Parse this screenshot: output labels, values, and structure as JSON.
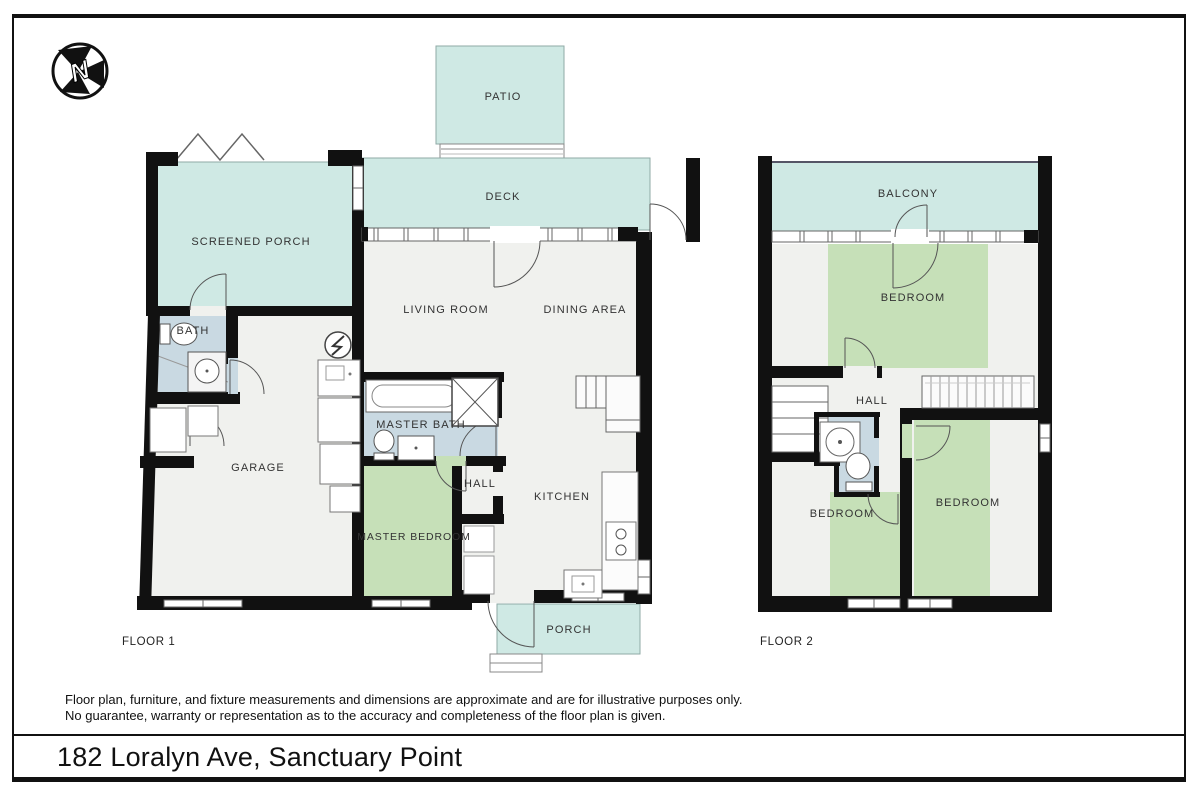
{
  "page": {
    "address": "182 Loralyn Ave, Sanctuary Point",
    "disclaimer_line1": "Floor plan, furniture, and fixture measurements and dimensions are approximate and are for illustrative purposes only.",
    "disclaimer_line2": "No guarantee, warranty or representation as to the accuracy and completeness of the floor plan is given.",
    "north_label": "N"
  },
  "floor1": {
    "label": "FLOOR 1",
    "rooms": {
      "patio": "PATIO",
      "deck": "DECK",
      "screened_porch": "SCREENED PORCH",
      "living_room": "LIVING ROOM",
      "dining_area": "DINING AREA",
      "bath": "BATH",
      "master_bath": "MASTER BATH",
      "garage": "GARAGE",
      "hall": "HALL",
      "kitchen": "KITCHEN",
      "master_bedroom": "MASTER BEDROOM",
      "porch": "PORCH"
    }
  },
  "floor2": {
    "label": "FLOOR 2",
    "rooms": {
      "balcony": "BALCONY",
      "bedroom_top": "BEDROOM",
      "hall": "HALL",
      "bedroom_left": "BEDROOM",
      "bedroom_right": "BEDROOM"
    }
  },
  "colors": {
    "outdoor_teal": "#cfe9e4",
    "bedroom_green": "#c6e0b8",
    "bath_blue": "#c9d9e2",
    "interior_floor": "#f0f1ee",
    "wall_black": "#111111"
  }
}
